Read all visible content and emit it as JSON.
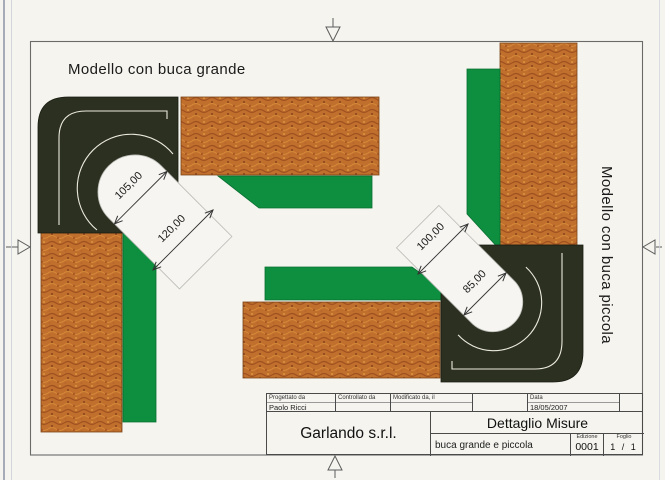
{
  "drawing": {
    "model_large_label": "Modello con buca grande",
    "model_small_label": "Modello con buca piccola",
    "dim_large_width": "105,00",
    "dim_large_opening": "120,00",
    "dim_small_opening": "100,00",
    "dim_small_width": "85,00"
  },
  "title_block": {
    "designed_label": "Progettato da",
    "designed_value": "Paolo Ricci",
    "checked_label": "Controllato da",
    "modified_label": "Modificato da, il",
    "date_label": "Data",
    "date_value": "18/05/2007",
    "company": "Garlando s.r.l.",
    "doc_title": "Dettaglio Misure",
    "doc_subtitle": "buca grande e piccola",
    "edition_label": "Edizione",
    "edition_value": "0001",
    "sheet_label": "Foglio",
    "sheet_value": "1 / 1"
  },
  "colors": {
    "paper": "#f5f4ef",
    "frame_line": "#6a6a6a",
    "dark_piece": "#2b3020",
    "cloth_green": "#0e8f3f",
    "wood_base": "#c16f2d"
  }
}
